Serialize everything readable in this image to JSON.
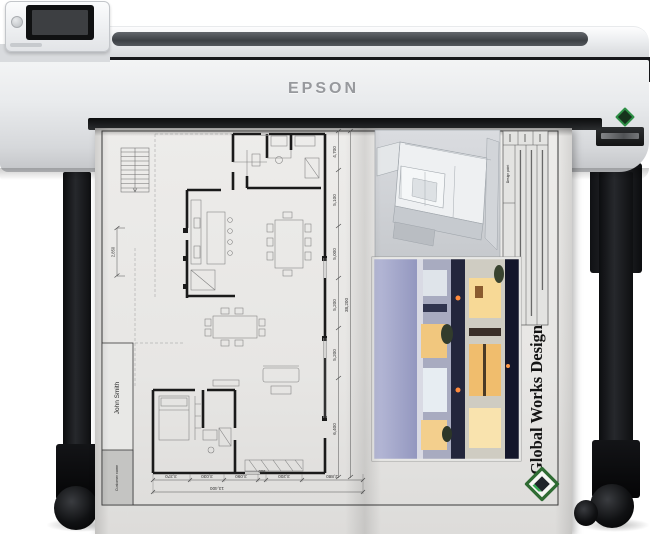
{
  "printer": {
    "brand": "EPSON"
  },
  "sheet": {
    "title_block": {
      "customer_label": "Customer name",
      "customer_name": "John Smith"
    },
    "company_name": "Global Works Design",
    "notes_table": {
      "column_header": "Design point",
      "section_label": "Notes"
    },
    "dimensions": {
      "vertical": [
        "4,700",
        "5,100",
        "5,000",
        "5,200",
        "5,200",
        "6,400"
      ],
      "vertical_total": "38,200",
      "horizontal": [
        "3,370",
        "3,030",
        "3,090",
        "900",
        "3,200",
        "2,880"
      ],
      "horizontal_total": "13,400",
      "stair_width": "2,850"
    }
  },
  "colors": {
    "accent_green": "#2e8f46",
    "paper": "#eae9e7",
    "body_gray": "#e9ebed",
    "stripe_dark": "#17181b",
    "window_warm": "#f0bd6d",
    "sky_blue": "#8d91bb"
  }
}
